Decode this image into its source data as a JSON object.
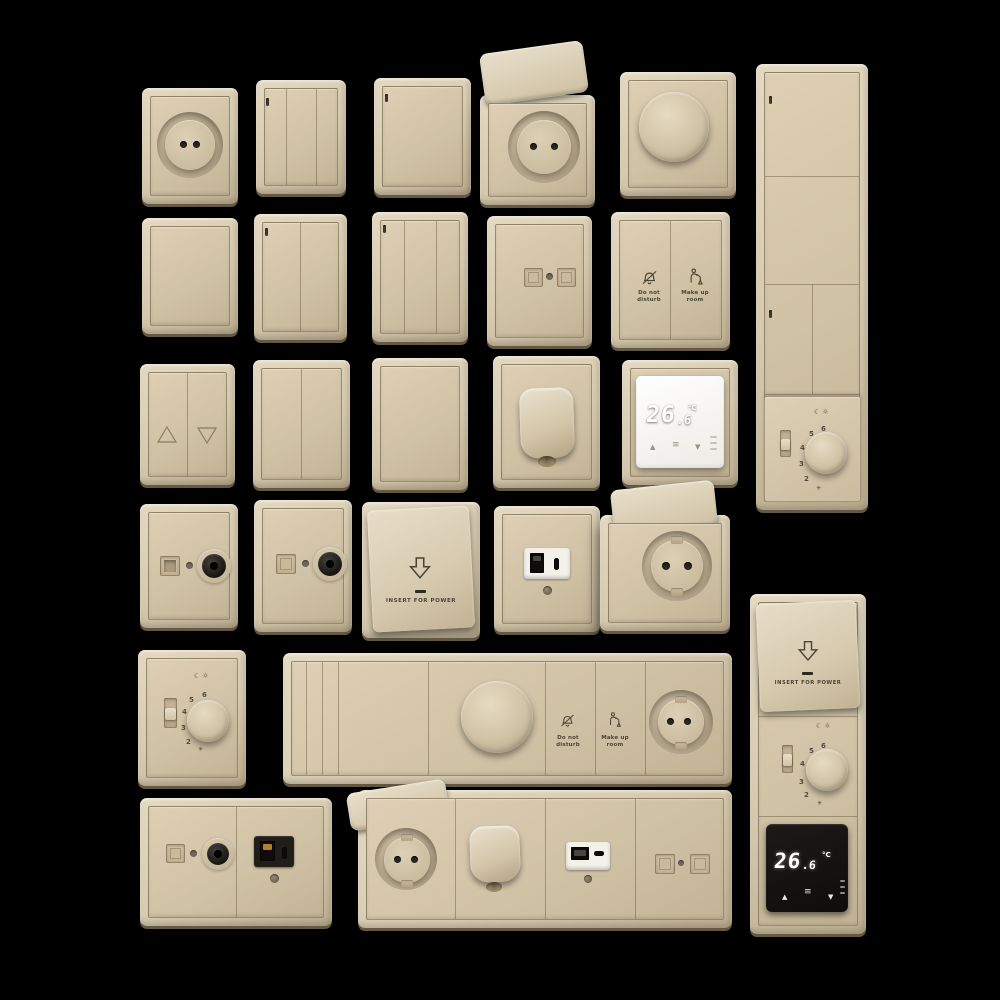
{
  "scene": {
    "background": "#000000",
    "palette": {
      "plate_beige": "#d6c9ae",
      "plate_highlight": "#e4d9c1",
      "plate_shadow": "#bdae90",
      "engraving": "#4a4334",
      "display_black": "#141210",
      "display_digits": "#ffffff",
      "insert_white": "#f4f1ea",
      "port_black": "#0f0d0b",
      "usb_contact_orange": "#b77e33",
      "thermostat_face_white": "#f7f6f2"
    }
  },
  "labels": {
    "do_not_disturb": "Do not\ndisturb",
    "make_up_room": "Make up\nroom",
    "insert_for_power": "INSERT FOR POWER"
  },
  "thermostat": {
    "whole": "26",
    "separator": ".",
    "decimal": "6",
    "unit": "°C",
    "up_arrow": "▲",
    "down_arrow": "▼",
    "menu_icon": "≡"
  },
  "dial": {
    "numbers": [
      "6",
      "5",
      "4",
      "3",
      "2"
    ],
    "moon_icon": "☾",
    "sun_icon": "☼",
    "frost_icon": "✳"
  }
}
